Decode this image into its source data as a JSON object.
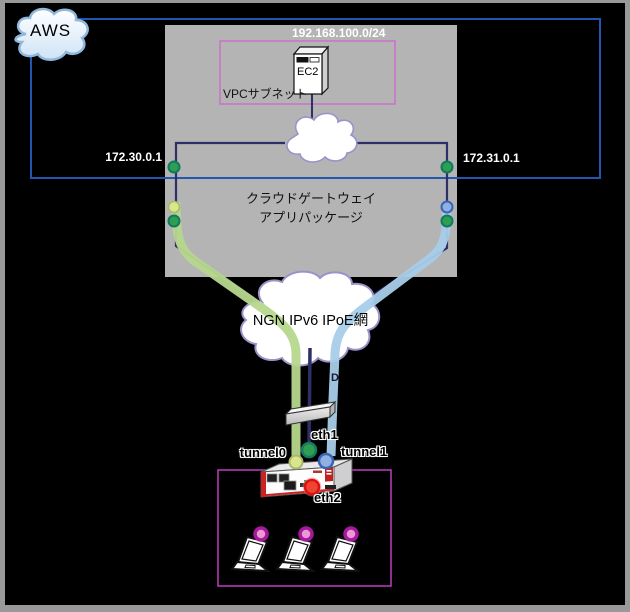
{
  "aws": {
    "label": "AWS"
  },
  "vpc": {
    "cidr": "192.168.100.0/24",
    "subnet_label": "VPCサブネット",
    "ec2_label": "EC2"
  },
  "gateway": {
    "line1": "クラウドゲートウェイ",
    "line2": "アプリパッケージ",
    "ip_left": "172.30.0.1",
    "ip_right": "172.31.0.1"
  },
  "ngn": {
    "label": "NGN IPv6 IPoE網",
    "partial_label": "D"
  },
  "router": {
    "ports": {
      "tunnel0": "tunnel0",
      "eth1": "eth1",
      "tunnel1": "tunnel1",
      "eth2": "eth2"
    }
  },
  "lan": {
    "client_count": 3
  },
  "colors": {
    "aws_border": "#2257b0",
    "vpc_border": "#cc66cc",
    "lan_border": "#b13ab1",
    "line_navy": "#2e2f66",
    "tunnel_green": "#b6d88e",
    "tunnel_blue": "#a8cde9",
    "dot_green": "#2f9e50",
    "dot_lime": "#d9e68c",
    "dot_blue": "#8fb0e0",
    "dot_red": "#ee4433",
    "dot_pink": "#ef97d4",
    "cloud_border": "#9a92c8",
    "gateway_box_fill": "#b4b4b4"
  }
}
